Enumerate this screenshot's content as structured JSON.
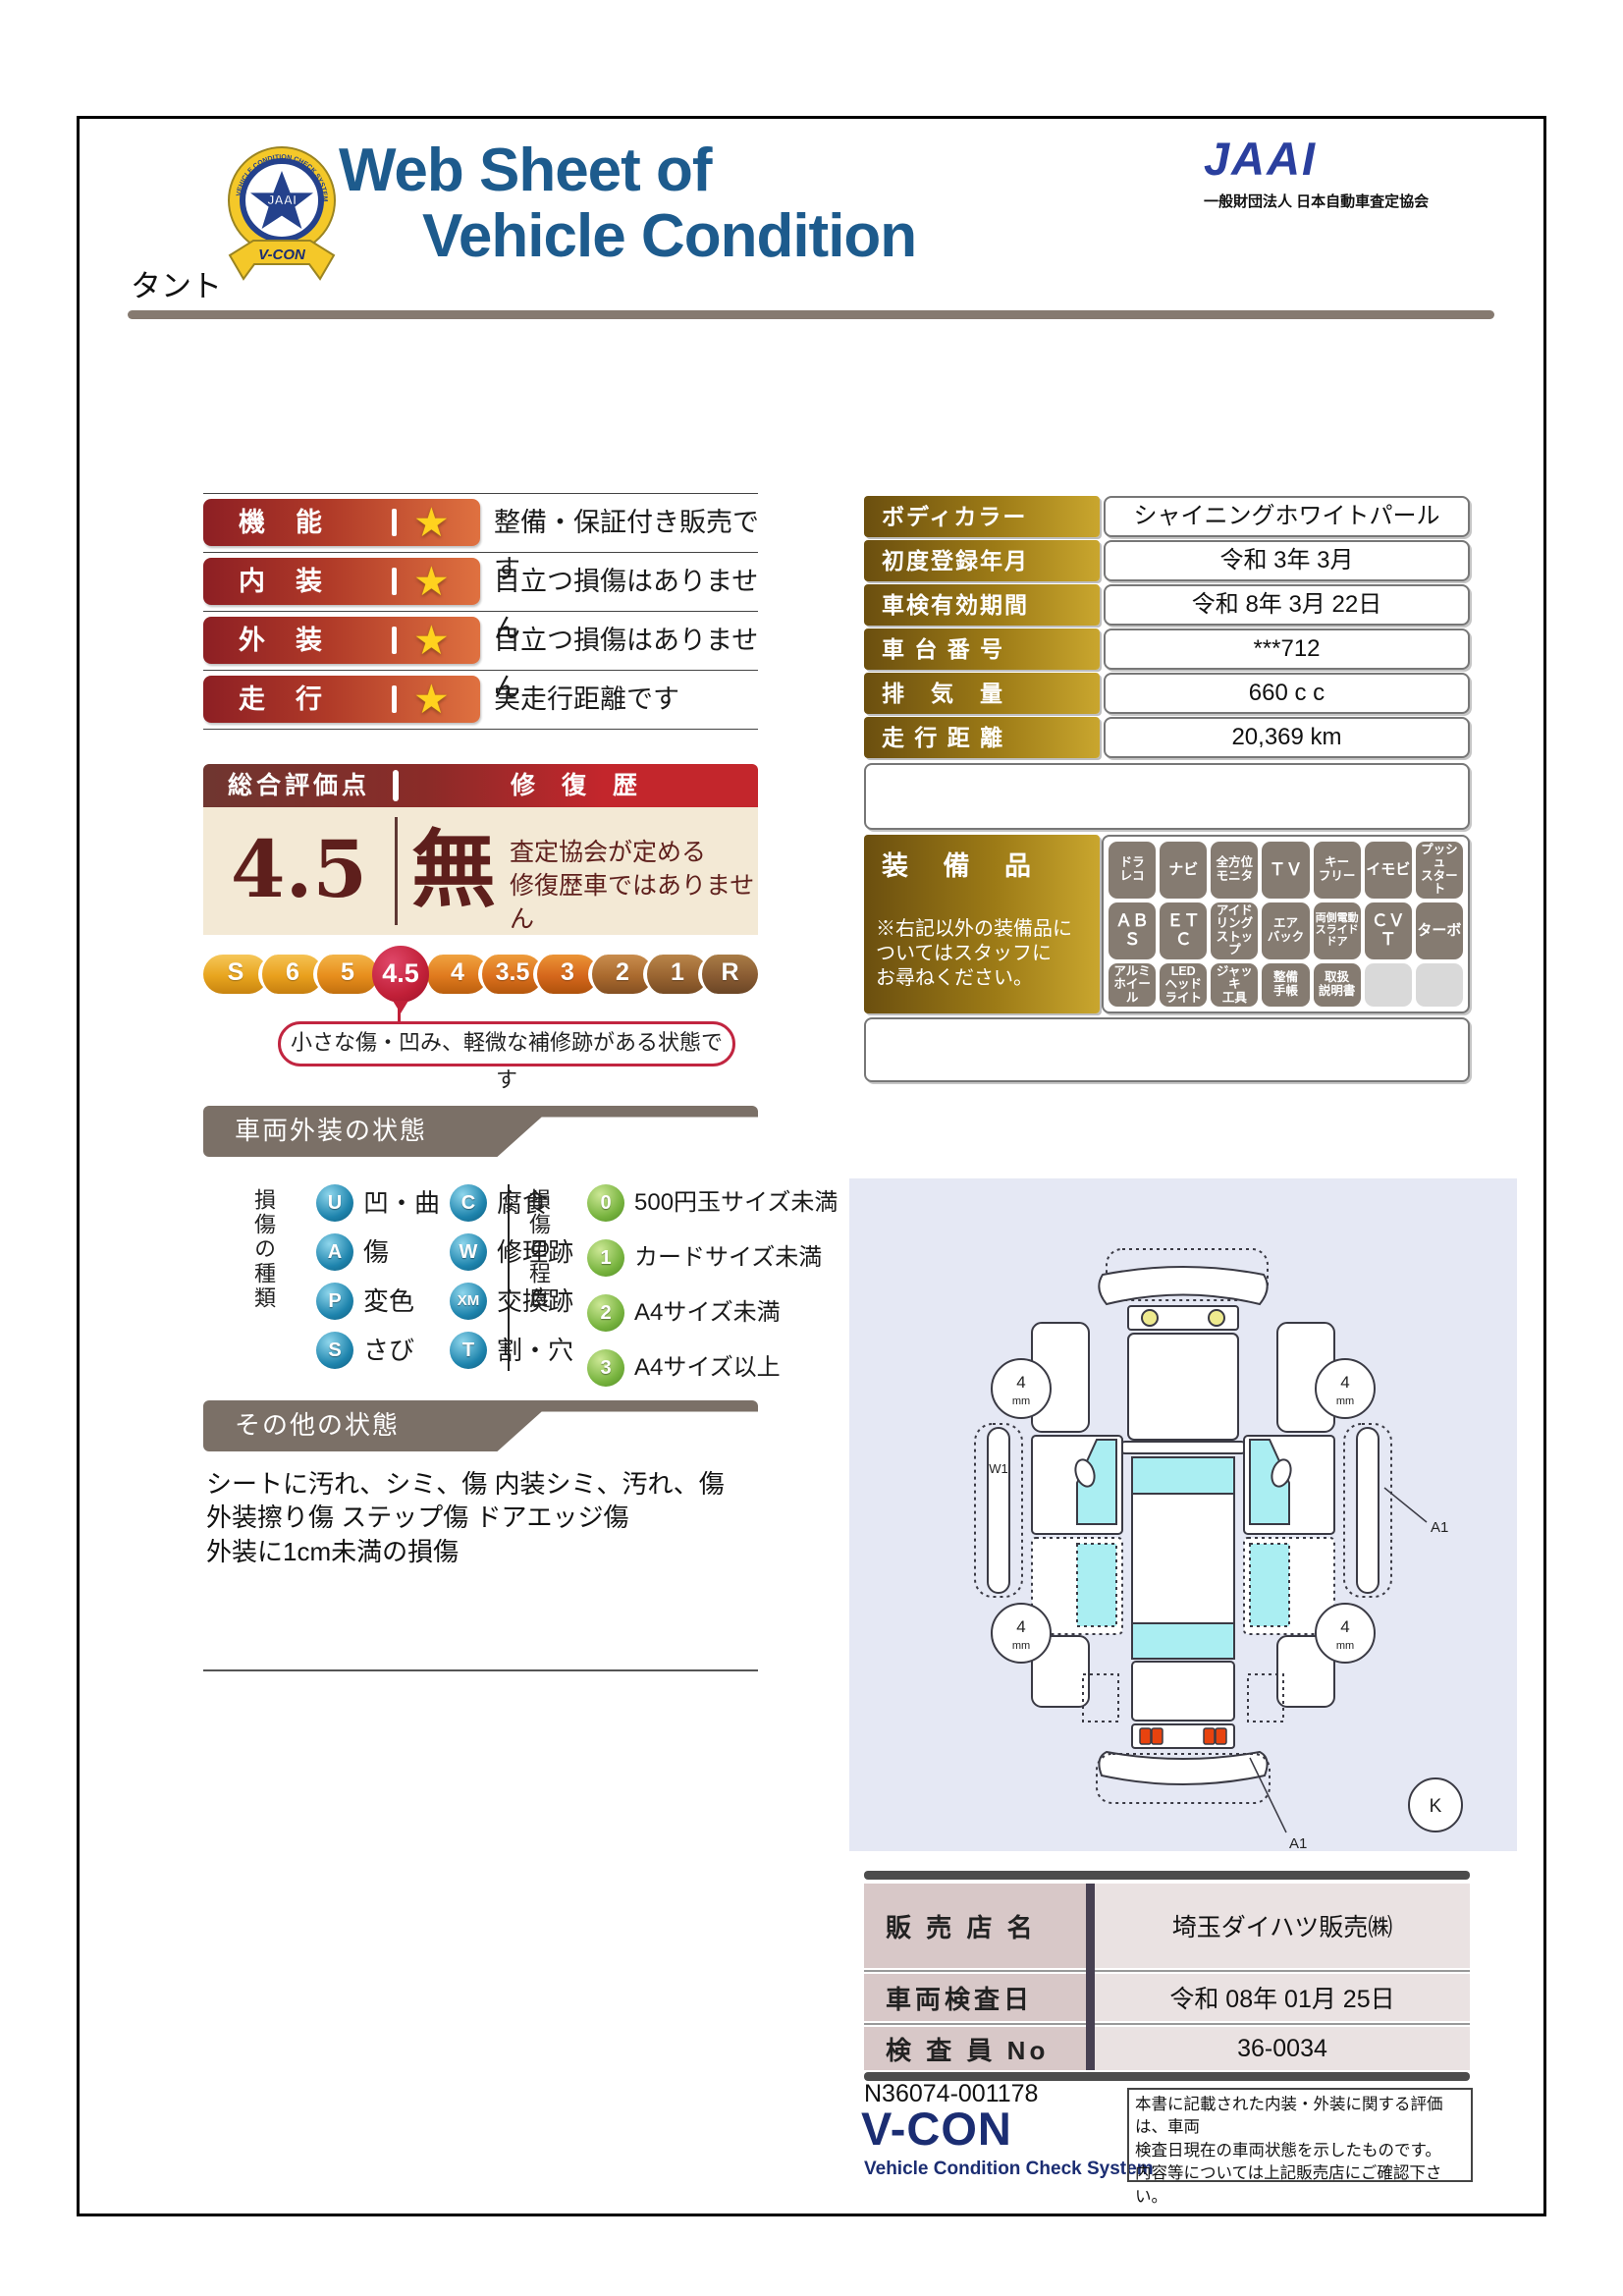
{
  "colors": {
    "title_blue": "#1d5b8d",
    "jaai_blue": "#2a3f9e",
    "maroon": "#5e1f1c",
    "header_red": "#c3262c",
    "gold": "#9c7a16",
    "crimson": "#c12038",
    "taupe": "#7b7067"
  },
  "header": {
    "title_line1": "Web Sheet of",
    "title_line2": "Vehicle Condition",
    "jaai_logo": "JAAI",
    "jaai_org": "一般財団法人 日本自動車査定協会",
    "badge": {
      "ring_text": "VEHICLE CONDITION CHECK SYSTEM",
      "center": "JAAI",
      "ribbon": "V-CON"
    }
  },
  "vehicle_name": "タント",
  "ratings": [
    {
      "label": "機　能",
      "star": "★",
      "desc": "整備・保証付き販売です"
    },
    {
      "label": "内　装",
      "star": "★",
      "desc": "目立つ損傷はありません"
    },
    {
      "label": "外　装",
      "star": "★",
      "desc": "目立つ損傷はありません"
    },
    {
      "label": "走　行",
      "star": "★",
      "desc": "実走行距離です"
    }
  ],
  "overall": {
    "header_left": "総合評価点",
    "header_right": "修 復 歴",
    "score": "4.5",
    "repair_none": "無",
    "repair_desc": "査定協会が定める\n修復歴車ではありません",
    "scale": [
      "S",
      "6",
      "5",
      "4.5",
      "4",
      "3.5",
      "3",
      "2",
      "1",
      "R"
    ],
    "selected": "4.5",
    "bubble": "小さな傷・凹み、軽微な補修跡がある状態です"
  },
  "details": {
    "rows": [
      {
        "label": "ボディカラー",
        "value": "シャイニングホワイトパール"
      },
      {
        "label": "初度登録年月",
        "value": "令和 3年 3月"
      },
      {
        "label": "車検有効期間",
        "value": "令和 8年 3月 22日"
      },
      {
        "label": "車 台 番 号",
        "value": "***712"
      },
      {
        "label": "排　気　量",
        "value": "660 c c"
      },
      {
        "label": "走 行 距 離",
        "value": "20,369 km"
      }
    ]
  },
  "equipment": {
    "title": "装 備 品",
    "note": "※右記以外の装備品に\nついてはスタッフに\nお尋ねください。",
    "badges": [
      "ドラ\nレコ",
      "ナビ",
      "全方位\nモニタ",
      "ＴＶ",
      "キー\nフリー",
      "イモビ",
      "プッシュ\nスタート",
      "ＡＢＳ",
      "ＥＴＣ",
      "アイド\nリング\nストップ",
      "エア\nバック",
      "両側電動\nスライド\nドア",
      "ＣＶＴ",
      "ターボ",
      "アルミ\nホイール",
      "LED\nヘッド\nライト",
      "ジャッキ\n工具",
      "整備\n手帳",
      "取扱\n説明書",
      "",
      ""
    ]
  },
  "exterior": {
    "section_title": "車両外装の状態",
    "type_title": "損傷の種類",
    "types": [
      {
        "code": "U",
        "label": "凹・曲"
      },
      {
        "code": "A",
        "label": "傷"
      },
      {
        "code": "P",
        "label": "変色"
      },
      {
        "code": "S",
        "label": "さび"
      },
      {
        "code": "C",
        "label": "腐食"
      },
      {
        "code": "W",
        "label": "修理跡"
      },
      {
        "code": "XM",
        "label": "交換跡"
      },
      {
        "code": "T",
        "label": "割・穴"
      }
    ],
    "degree_title": "損傷の程度",
    "degrees": [
      {
        "code": "0",
        "label": "500円玉サイズ未満"
      },
      {
        "code": "1",
        "label": "カードサイズ未満"
      },
      {
        "code": "2",
        "label": "A4サイズ未満"
      },
      {
        "code": "3",
        "label": "A4サイズ以上"
      }
    ]
  },
  "other": {
    "section_title": "その他の状態",
    "lines": "シートに汚れ、シミ、傷 内装シミ、汚れ、傷\n外装擦り傷 ステップ傷 ドアエッジ傷\n外装に1cm未満の損傷"
  },
  "diagram": {
    "tire_depth": "4",
    "tire_unit": "mm",
    "left_rocker_mark": "W1",
    "right_panel_mark": "A1",
    "rear_bumper_mark": "A1",
    "key_symbol": "K"
  },
  "dealer": {
    "rows": [
      {
        "label": "販 売 店 名",
        "value": "埼玉ダイハツ販売㈱"
      },
      {
        "label": "車両検査日",
        "value": "令和 08年 01月 25日"
      },
      {
        "label": "検 査 員 No",
        "value": "36-0034"
      }
    ]
  },
  "footer": {
    "doc_no": "N36074-001178",
    "vcon": "V-CON",
    "vcon_sub": "Vehicle Condition Check System",
    "disclaimer": "本書に記載された内装・外装に関する評価は、車両\n検査日現在の車両状態を示したものです。\n内容等については上記販売店にご確認下さい。"
  }
}
